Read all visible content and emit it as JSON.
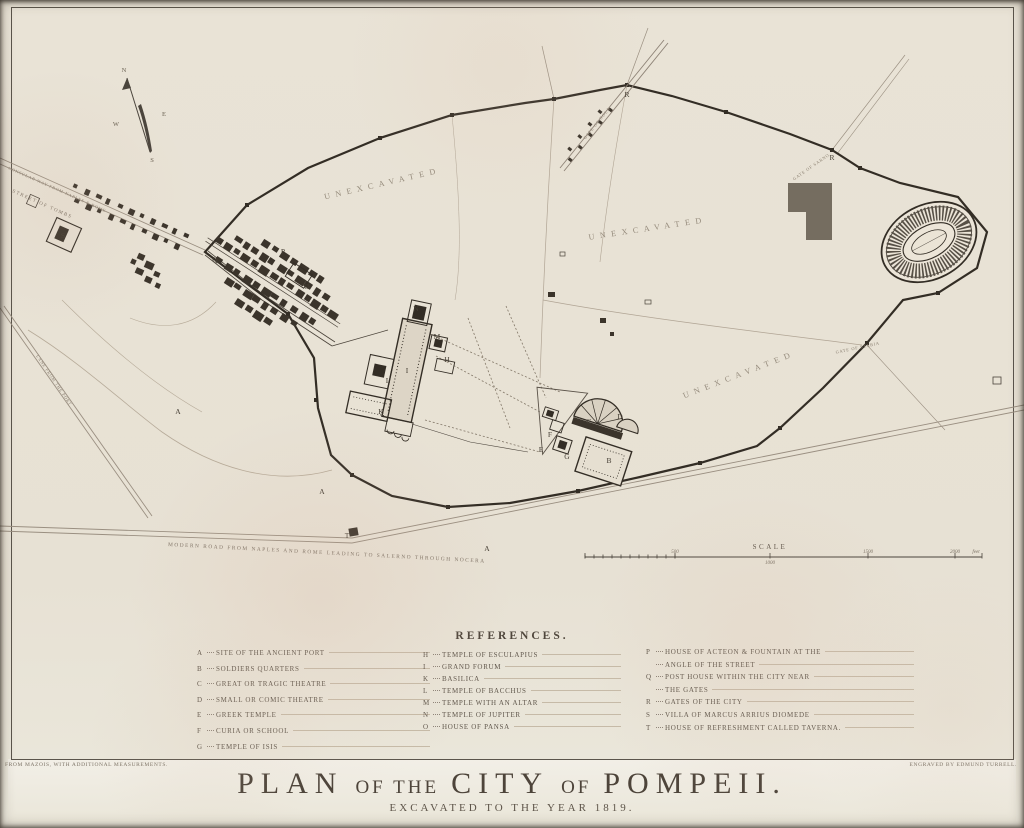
{
  "plate": {
    "title_parts": [
      "PLAN",
      "OF THE",
      "CITY",
      "OF",
      "POMPEII."
    ],
    "subtitle": "EXCAVATED TO THE YEAR 1819.",
    "credit_left": "FROM MAZOIS, WITH ADDITIONAL MEASUREMENTS.",
    "credit_right": "ENGRAVED BY EDMUND TURRELL."
  },
  "map": {
    "labels": {
      "unexcavated": "UNEXCAVATED",
      "consular_way": "CONSULAR WAY FROM NAPLES & ROME",
      "street_of_tombs": "STREET OF TOMBS",
      "lane_from_port": "LANE FROM THE PORT",
      "modern_road": "MODERN ROAD FROM NAPLES AND ROME LEADING TO SALERNO THROUGH NOCERA",
      "gate_nola": "GATE OF NOLA",
      "gate_sarno": "GATE OF SARNO",
      "gate_stabia": "GATE OF STABIA"
    },
    "compass": {
      "n": "N",
      "e": "E",
      "s": "S",
      "w": "W"
    },
    "scale": {
      "label": "SCALE",
      "ticks": [
        "500",
        "1000",
        "1500",
        "2000"
      ],
      "unit": "feet"
    },
    "letters": [
      {
        "t": "A",
        "x": 178,
        "y": 414
      },
      {
        "t": "A",
        "x": 322,
        "y": 494
      },
      {
        "t": "A",
        "x": 487,
        "y": 551
      },
      {
        "t": "B",
        "x": 609,
        "y": 463
      },
      {
        "t": "C",
        "x": 589,
        "y": 424
      },
      {
        "t": "D",
        "x": 620,
        "y": 419
      },
      {
        "t": "E",
        "x": 541,
        "y": 452
      },
      {
        "t": "F",
        "x": 550,
        "y": 437
      },
      {
        "t": "G",
        "x": 567,
        "y": 459
      },
      {
        "t": "H",
        "x": 447,
        "y": 362
      },
      {
        "t": "I",
        "x": 407,
        "y": 373
      },
      {
        "t": "K",
        "x": 381,
        "y": 414
      },
      {
        "t": "L",
        "x": 388,
        "y": 383
      },
      {
        "t": "M",
        "x": 437,
        "y": 339
      },
      {
        "t": "N",
        "x": 416,
        "y": 311
      },
      {
        "t": "O",
        "x": 307,
        "y": 289
      },
      {
        "t": "P",
        "x": 283,
        "y": 254
      },
      {
        "t": "Q",
        "x": 215,
        "y": 262
      },
      {
        "t": "R",
        "x": 627,
        "y": 97
      },
      {
        "t": "R",
        "x": 832,
        "y": 160
      },
      {
        "t": "S",
        "x": 63,
        "y": 238
      },
      {
        "t": "T",
        "x": 347,
        "y": 538
      }
    ]
  },
  "references": {
    "heading": "REFERENCES.",
    "columns": [
      {
        "entries": [
          {
            "letter": "A",
            "lines": [
              "SITE OF THE ANCIENT PORT"
            ]
          },
          {
            "letter": "B",
            "lines": [
              "SOLDIERS QUARTERS"
            ]
          },
          {
            "letter": "C",
            "lines": [
              "GREAT OR TRAGIC THEATRE"
            ]
          },
          {
            "letter": "D",
            "lines": [
              "SMALL OR COMIC THEATRE"
            ]
          },
          {
            "letter": "E",
            "lines": [
              "GREEK TEMPLE"
            ]
          },
          {
            "letter": "F",
            "lines": [
              "CURIA OR SCHOOL"
            ]
          },
          {
            "letter": "G",
            "lines": [
              "TEMPLE OF ISIS"
            ]
          }
        ]
      },
      {
        "entries": [
          {
            "letter": "H",
            "lines": [
              "TEMPLE OF ESCULAPIUS"
            ]
          },
          {
            "letter": "I",
            "lines": [
              "GRAND FORUM"
            ]
          },
          {
            "letter": "K",
            "lines": [
              "BASILICA"
            ]
          },
          {
            "letter": "L",
            "lines": [
              "TEMPLE OF BACCHUS"
            ]
          },
          {
            "letter": "M",
            "lines": [
              "TEMPLE WITH AN ALTAR"
            ]
          },
          {
            "letter": "N",
            "lines": [
              "TEMPLE OF JUPITER"
            ]
          },
          {
            "letter": "O",
            "lines": [
              "HOUSE OF PANSA"
            ]
          }
        ]
      },
      {
        "entries": [
          {
            "letter": "P",
            "lines": [
              "HOUSE OF ACTEON & FOUNTAIN AT THE",
              "ANGLE OF THE STREET"
            ]
          },
          {
            "letter": "Q",
            "lines": [
              "POST HOUSE WITHIN THE CITY NEAR",
              "THE GATES"
            ]
          },
          {
            "letter": "R",
            "lines": [
              "GATES OF THE CITY"
            ]
          },
          {
            "letter": "S",
            "lines": [
              "VILLA OF MARCUS ARRIUS DIOMEDE"
            ]
          },
          {
            "letter": "T",
            "lines": [
              "HOUSE OF REFRESHMENT CALLED TAVERNA."
            ]
          }
        ]
      }
    ]
  }
}
